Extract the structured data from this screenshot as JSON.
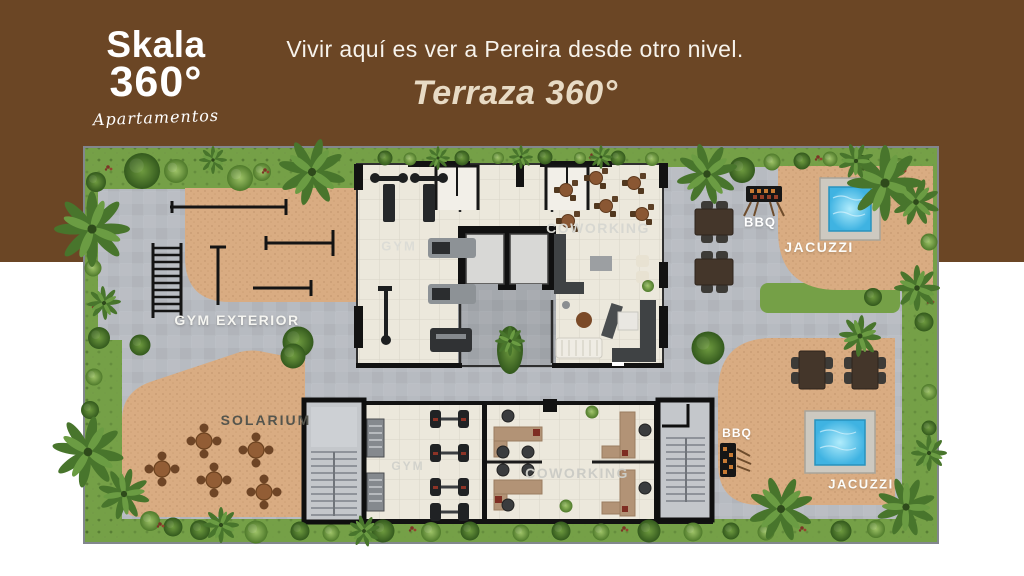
{
  "header": {
    "logo": {
      "name": "Skala",
      "degree": "360°",
      "sub": "Apartamentos"
    },
    "headline": "Vivir aquí es ver a Pereira desde otro nivel.",
    "subtitle": "Terraza 360°"
  },
  "floorplan_labels": {
    "gym_top": "GYM",
    "coworking_top": "COWORKING",
    "gym_exterior": "GYM EXTERIOR",
    "solarium": "SOLARIUM",
    "bbq_top": "BBQ",
    "jacuzzi_top": "JACUZZI",
    "gym_bottom": "GYM",
    "coworking_bottom": "COWORKING",
    "bbq_bottom": "BBQ",
    "jacuzzi_bottom": "JACUZZI"
  },
  "colors": {
    "header_brown": "#6b4625",
    "subtitle_cream": "#e8dbc5",
    "path_gray": "#b7bbc1",
    "terrace_tan": "#d9ac82",
    "interior_beige": "#ece8dc",
    "vegetation_green": "#75a047",
    "jacuzzi_water_blue": "#5ec9ee",
    "wall_black": "#121212",
    "wood_brown": "#44362a"
  }
}
